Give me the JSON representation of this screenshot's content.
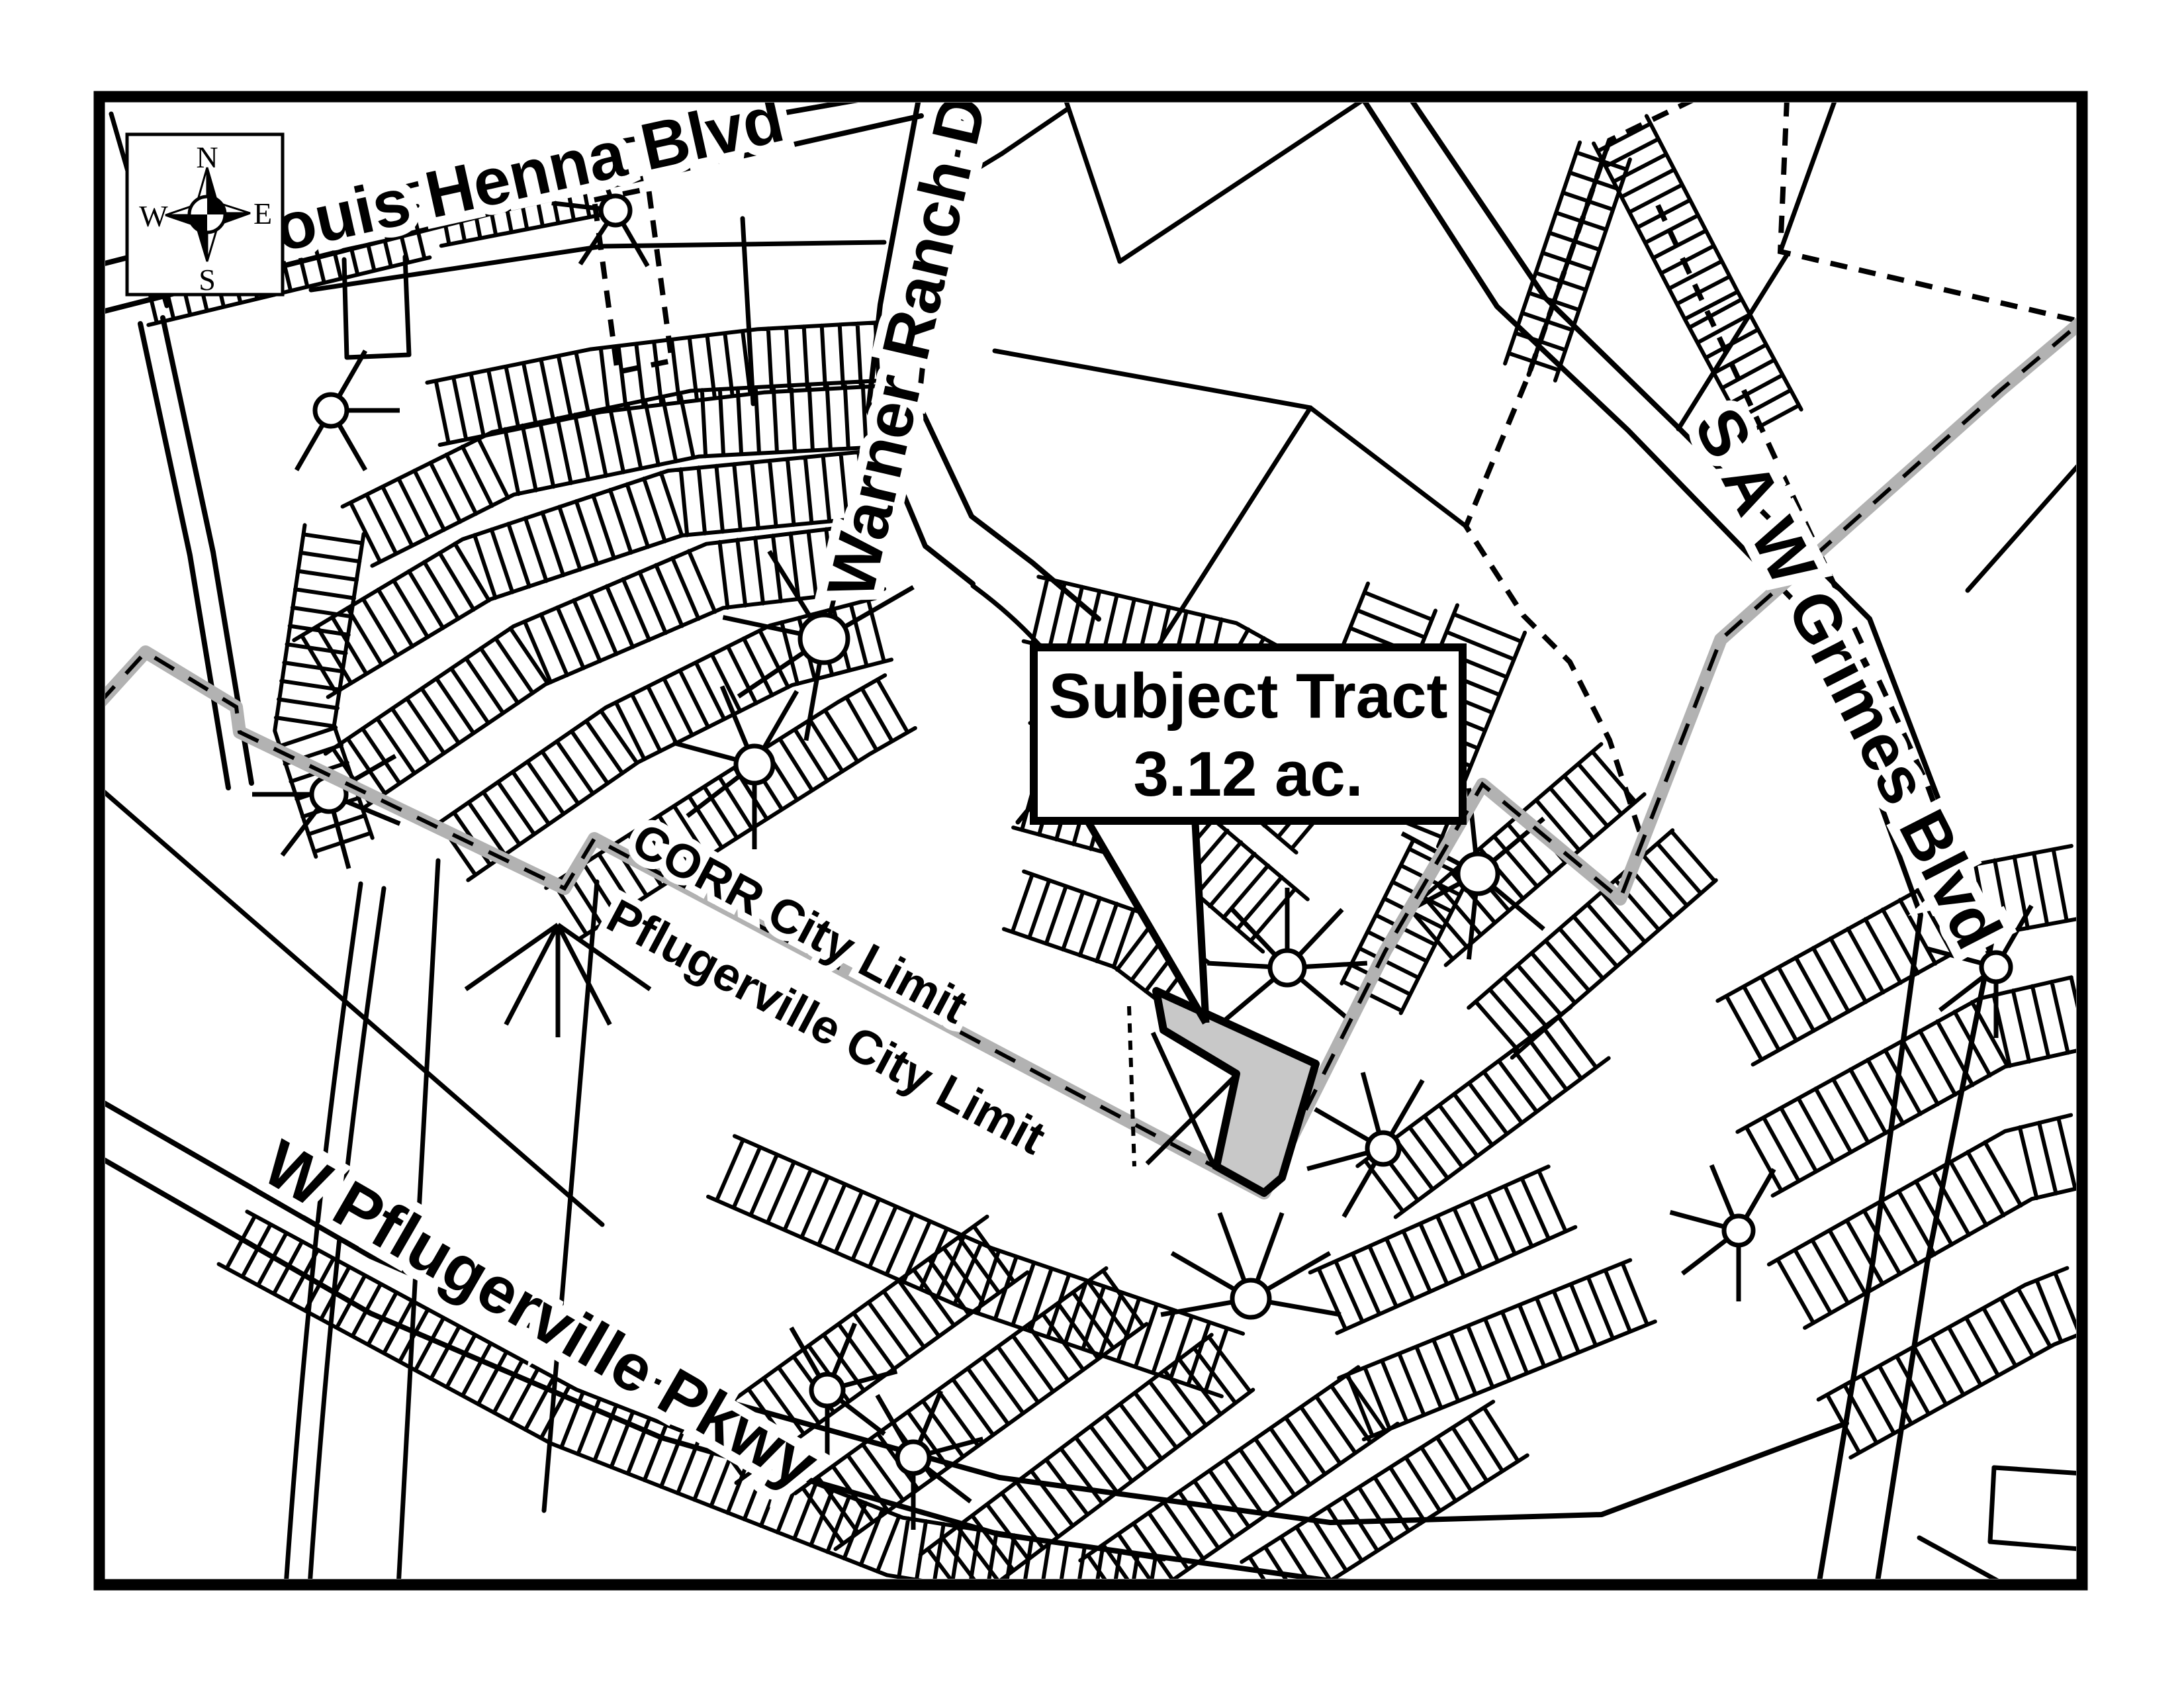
{
  "callout": {
    "line1": "Subject Tract",
    "line2": "3.12 ac."
  },
  "street_labels": [
    {
      "id": "louis-henna-blvd",
      "text": "Louis Henna Blvd"
    },
    {
      "id": "warner-ranch-dr",
      "text": "Warner Ranch Dr"
    },
    {
      "id": "saw-grimes-blvd",
      "text": "S A W Grimes Blvd"
    },
    {
      "id": "w-pflugerville-pkwy",
      "text": "W Pflugerville Pkwy"
    }
  ],
  "boundary_labels": [
    {
      "id": "corr-city-limit",
      "text": "CORR City Limit"
    },
    {
      "id": "pflugerville-city-limit",
      "text": "Pflugerville City Limit"
    }
  ],
  "compass": {
    "north": "N",
    "south": "S",
    "east": "E",
    "west": "W"
  },
  "colors": {
    "ink": "#000000",
    "paper": "#ffffff",
    "tract_fill": "#c8c8c8",
    "city_limit_gray": "#b2b2b2"
  }
}
